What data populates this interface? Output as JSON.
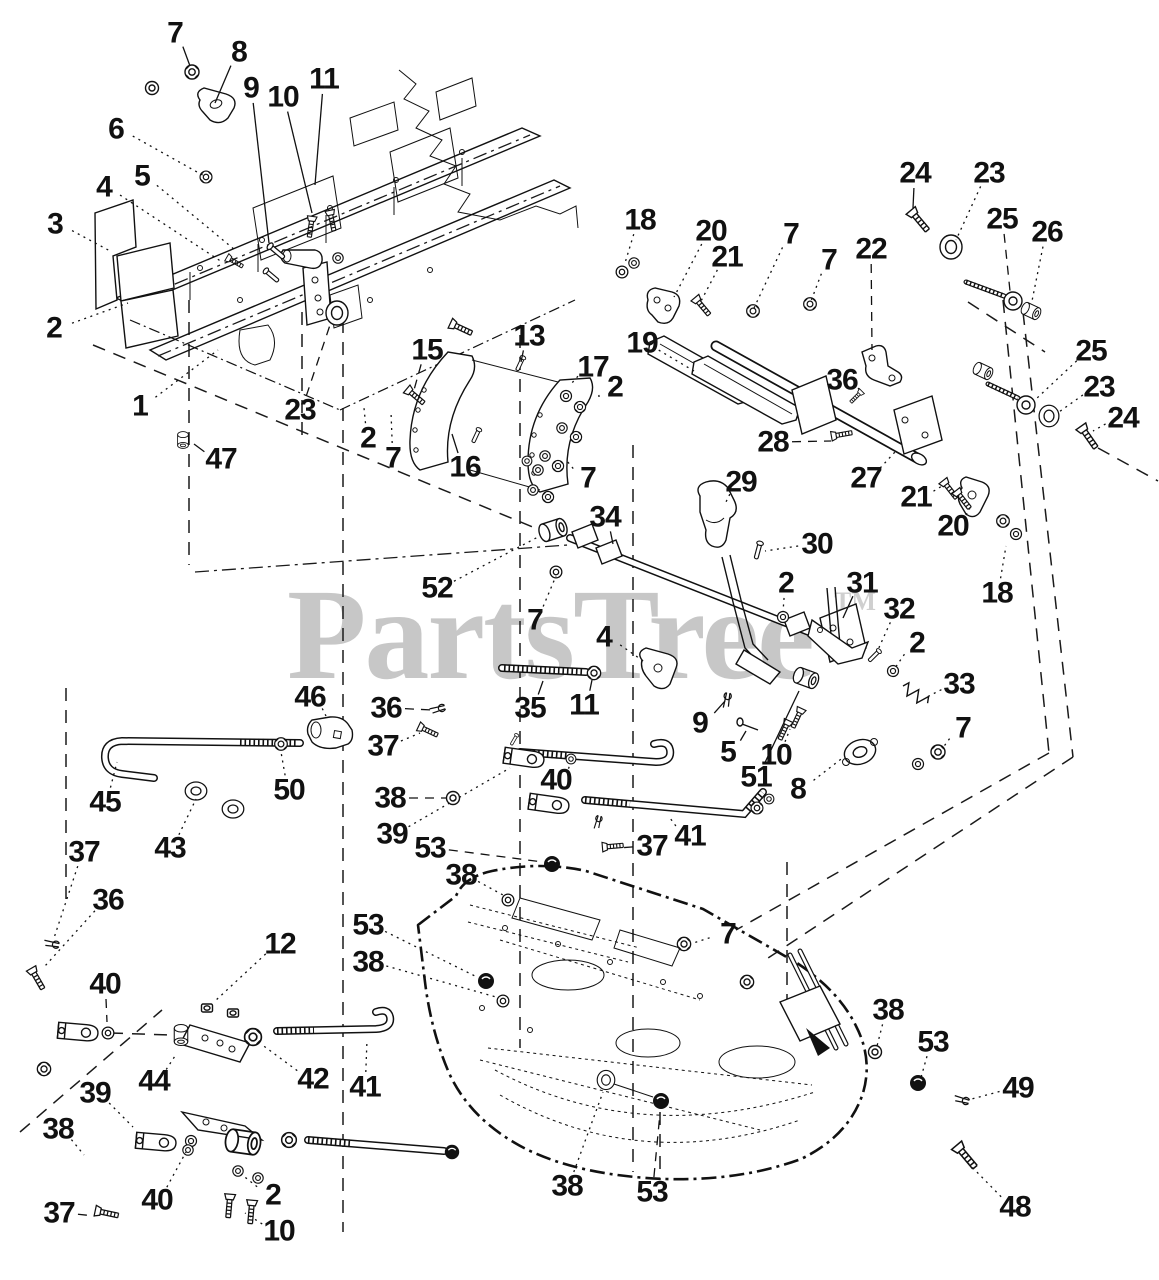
{
  "watermark": {
    "text": "PartsTree",
    "tm": "TM",
    "color": "#c7c7c7"
  },
  "diagram": {
    "ink": "#111111",
    "background": "#ffffff",
    "type": "exploded-parts-diagram",
    "subject": "mower deck lift linkage"
  },
  "callouts": [
    {
      "n": "7",
      "x": 175,
      "y": 33,
      "tx": 190,
      "ty": 66,
      "ls": "s"
    },
    {
      "n": "8",
      "x": 239,
      "y": 52,
      "tx": 215,
      "ty": 103,
      "ls": "s"
    },
    {
      "n": "9",
      "x": 251,
      "y": 88,
      "tx": 269,
      "ty": 243,
      "ls": "s"
    },
    {
      "n": "10",
      "x": 283,
      "y": 97,
      "tx": 312,
      "ty": 213,
      "ls": "s"
    },
    {
      "n": "11",
      "x": 324,
      "y": 79,
      "tx": 315,
      "ty": 185,
      "ls": "s"
    },
    {
      "n": "6",
      "x": 116,
      "y": 129,
      "tx": 206,
      "ty": 177,
      "ls": "o"
    },
    {
      "n": "5",
      "x": 142,
      "y": 176,
      "tx": 235,
      "ty": 250,
      "ls": "o"
    },
    {
      "n": "4",
      "x": 104,
      "y": 187,
      "tx": 222,
      "ty": 262,
      "ls": "o"
    },
    {
      "n": "3",
      "x": 55,
      "y": 224,
      "tx": 112,
      "ty": 252,
      "ls": "o"
    },
    {
      "n": "2",
      "x": 54,
      "y": 328,
      "tx": 128,
      "ty": 303,
      "ls": "o"
    },
    {
      "n": "1",
      "x": 140,
      "y": 406,
      "tx": 218,
      "ty": 350,
      "ls": "o"
    },
    {
      "n": "23",
      "x": 300,
      "y": 410,
      "tx": 331,
      "ty": 322,
      "ls": "a"
    },
    {
      "n": "47",
      "x": 221,
      "y": 459,
      "tx": 194,
      "ty": 444,
      "ls": "s"
    },
    {
      "n": "15",
      "x": 427,
      "y": 350,
      "tx": 414,
      "ty": 390,
      "ls": "a"
    },
    {
      "n": "13",
      "x": 529,
      "y": 336,
      "tx": 521,
      "ty": 362,
      "ls": "s"
    },
    {
      "n": "17",
      "x": 593,
      "y": 367,
      "tx": 571,
      "ty": 384,
      "ls": "o"
    },
    {
      "n": "2",
      "x": 615,
      "y": 387,
      "tx": 599,
      "ty": 397,
      "ls": "a"
    },
    {
      "n": "16",
      "x": 465,
      "y": 467,
      "tx": 452,
      "ty": 434,
      "ls": "s"
    },
    {
      "n": "7",
      "x": 588,
      "y": 478,
      "tx": 567,
      "ty": 461,
      "ls": "o"
    },
    {
      "n": "2",
      "x": 368,
      "y": 438,
      "tx": 364,
      "ty": 408,
      "ls": "o"
    },
    {
      "n": "7",
      "x": 393,
      "y": 458,
      "tx": 391,
      "ty": 412,
      "ls": "o"
    },
    {
      "n": "18",
      "x": 640,
      "y": 220,
      "tx": 625,
      "ty": 263,
      "ls": "o"
    },
    {
      "n": "20",
      "x": 711,
      "y": 231,
      "tx": 674,
      "ty": 297,
      "ls": "o"
    },
    {
      "n": "21",
      "x": 727,
      "y": 257,
      "tx": 700,
      "ty": 303,
      "ls": "o"
    },
    {
      "n": "7",
      "x": 791,
      "y": 234,
      "tx": 754,
      "ty": 308,
      "ls": "o"
    },
    {
      "n": "7",
      "x": 829,
      "y": 260,
      "tx": 811,
      "ty": 301,
      "ls": "o"
    },
    {
      "n": "22",
      "x": 871,
      "y": 249,
      "tx": 872,
      "ty": 350,
      "ls": "a"
    },
    {
      "n": "24",
      "x": 915,
      "y": 173,
      "tx": 913,
      "ty": 208,
      "ls": "s"
    },
    {
      "n": "23",
      "x": 989,
      "y": 173,
      "tx": 956,
      "ty": 240,
      "ls": "o"
    },
    {
      "n": "25",
      "x": 1002,
      "y": 219,
      "tx": 1010,
      "ty": 291,
      "ls": "a"
    },
    {
      "n": "26",
      "x": 1047,
      "y": 232,
      "tx": 1032,
      "ty": 301,
      "ls": "o"
    },
    {
      "n": "19",
      "x": 642,
      "y": 343,
      "tx": 694,
      "ty": 371,
      "ls": "o"
    },
    {
      "n": "36",
      "x": 842,
      "y": 380,
      "tx": 861,
      "ty": 392,
      "ls": "o"
    },
    {
      "n": "28",
      "x": 773,
      "y": 442,
      "tx": 831,
      "ty": 441,
      "ls": "a"
    },
    {
      "n": "27",
      "x": 866,
      "y": 478,
      "tx": 895,
      "ty": 452,
      "ls": "o"
    },
    {
      "n": "29",
      "x": 741,
      "y": 482,
      "tx": 725,
      "ty": 504,
      "ls": "o"
    },
    {
      "n": "21",
      "x": 916,
      "y": 497,
      "tx": 942,
      "ty": 486,
      "ls": "o"
    },
    {
      "n": "20",
      "x": 953,
      "y": 526,
      "tx": 970,
      "ty": 508,
      "ls": "o"
    },
    {
      "n": "18",
      "x": 997,
      "y": 593,
      "tx": 1006,
      "ty": 546,
      "ls": "o"
    },
    {
      "n": "25",
      "x": 1091,
      "y": 351,
      "tx": 1036,
      "ty": 399,
      "ls": "o"
    },
    {
      "n": "23",
      "x": 1099,
      "y": 387,
      "tx": 1059,
      "ty": 412,
      "ls": "o"
    },
    {
      "n": "24",
      "x": 1123,
      "y": 418,
      "tx": 1093,
      "ty": 431,
      "ls": "o"
    },
    {
      "n": "30",
      "x": 817,
      "y": 544,
      "tx": 765,
      "ty": 551,
      "ls": "o"
    },
    {
      "n": "34",
      "x": 605,
      "y": 517,
      "tx": 613,
      "ty": 544,
      "ls": "s"
    },
    {
      "n": "2",
      "x": 786,
      "y": 583,
      "tx": 783,
      "ty": 612,
      "ls": "o"
    },
    {
      "n": "31",
      "x": 862,
      "y": 583,
      "tx": 843,
      "ty": 618,
      "ls": "s"
    },
    {
      "n": "32",
      "x": 899,
      "y": 609,
      "tx": 877,
      "ty": 652,
      "ls": "o"
    },
    {
      "n": "2",
      "x": 917,
      "y": 643,
      "tx": 895,
      "ty": 668,
      "ls": "o"
    },
    {
      "n": "33",
      "x": 959,
      "y": 684,
      "tx": 927,
      "ty": 697,
      "ls": "o"
    },
    {
      "n": "7",
      "x": 963,
      "y": 728,
      "tx": 942,
      "ty": 749,
      "ls": "o"
    },
    {
      "n": "52",
      "x": 437,
      "y": 588,
      "tx": 538,
      "ty": 537,
      "ls": "o"
    },
    {
      "n": "7",
      "x": 535,
      "y": 620,
      "tx": 556,
      "ty": 576,
      "ls": "o"
    },
    {
      "n": "4",
      "x": 604,
      "y": 637,
      "tx": 646,
      "ty": 663,
      "ls": "o"
    },
    {
      "n": "35",
      "x": 530,
      "y": 708,
      "tx": 543,
      "ty": 681,
      "ls": "s"
    },
    {
      "n": "11",
      "x": 584,
      "y": 705,
      "tx": 592,
      "ty": 680,
      "ls": "s"
    },
    {
      "n": "9",
      "x": 700,
      "y": 723,
      "tx": 725,
      "ty": 701,
      "ls": "s"
    },
    {
      "n": "5",
      "x": 728,
      "y": 752,
      "tx": 746,
      "ty": 731,
      "ls": "s"
    },
    {
      "n": "10",
      "x": 776,
      "y": 755,
      "tx": 790,
      "ty": 729,
      "ls": "o"
    },
    {
      "n": "51",
      "x": 756,
      "y": 777,
      "tx": 799,
      "ty": 691,
      "ls": "s"
    },
    {
      "n": "8",
      "x": 798,
      "y": 789,
      "tx": 845,
      "ty": 756,
      "ls": "o"
    },
    {
      "n": "46",
      "x": 310,
      "y": 697,
      "tx": 326,
      "ty": 716,
      "ls": "o"
    },
    {
      "n": "36",
      "x": 386,
      "y": 708,
      "tx": 432,
      "ty": 710,
      "ls": "a"
    },
    {
      "n": "37",
      "x": 383,
      "y": 746,
      "tx": 420,
      "ty": 733,
      "ls": "o"
    },
    {
      "n": "38",
      "x": 390,
      "y": 798,
      "tx": 447,
      "ty": 798,
      "ls": "a"
    },
    {
      "n": "39",
      "x": 392,
      "y": 834,
      "tx": 510,
      "ty": 768,
      "ls": "o"
    },
    {
      "n": "50",
      "x": 289,
      "y": 790,
      "tx": 281,
      "ty": 752,
      "ls": "o"
    },
    {
      "n": "45",
      "x": 105,
      "y": 802,
      "tx": 117,
      "ty": 762,
      "ls": "o"
    },
    {
      "n": "43",
      "x": 170,
      "y": 848,
      "tx": 196,
      "ty": 799,
      "ls": "o"
    },
    {
      "n": "37",
      "x": 84,
      "y": 852,
      "tx": 54,
      "ty": 938,
      "ls": "o"
    },
    {
      "n": "36",
      "x": 108,
      "y": 900,
      "tx": 45,
      "ty": 966,
      "ls": "o"
    },
    {
      "n": "12",
      "x": 280,
      "y": 944,
      "tx": 214,
      "ty": 1002,
      "ls": "o"
    },
    {
      "n": "40",
      "x": 556,
      "y": 780,
      "tx": 570,
      "ty": 764,
      "ls": "o"
    },
    {
      "n": "41",
      "x": 690,
      "y": 836,
      "tx": 670,
      "ty": 818,
      "ls": "o"
    },
    {
      "n": "37",
      "x": 652,
      "y": 846,
      "tx": 618,
      "ty": 848,
      "ls": "a"
    },
    {
      "n": "53",
      "x": 430,
      "y": 848,
      "tx": 543,
      "ty": 862,
      "ls": "a"
    },
    {
      "n": "38",
      "x": 461,
      "y": 875,
      "tx": 503,
      "ty": 895,
      "ls": "o"
    },
    {
      "n": "53",
      "x": 368,
      "y": 925,
      "tx": 477,
      "ty": 977,
      "ls": "o"
    },
    {
      "n": "38",
      "x": 368,
      "y": 962,
      "tx": 496,
      "ty": 997,
      "ls": "o"
    },
    {
      "n": "40",
      "x": 105,
      "y": 984,
      "tx": 107,
      "ty": 1022,
      "ls": "a"
    },
    {
      "n": "44",
      "x": 154,
      "y": 1081,
      "tx": 175,
      "ty": 1056,
      "ls": "o"
    },
    {
      "n": "42",
      "x": 313,
      "y": 1079,
      "tx": 261,
      "ty": 1044,
      "ls": "o"
    },
    {
      "n": "41",
      "x": 365,
      "y": 1087,
      "tx": 367,
      "ty": 1040,
      "ls": "o"
    },
    {
      "n": "39",
      "x": 95,
      "y": 1093,
      "tx": 133,
      "ty": 1127,
      "ls": "o"
    },
    {
      "n": "38",
      "x": 58,
      "y": 1129,
      "tx": 84,
      "ty": 1155,
      "ls": "o"
    },
    {
      "n": "40",
      "x": 157,
      "y": 1200,
      "tx": 186,
      "ty": 1152,
      "ls": "o"
    },
    {
      "n": "2",
      "x": 273,
      "y": 1195,
      "tx": 241,
      "ty": 1174,
      "ls": "o"
    },
    {
      "n": "37",
      "x": 59,
      "y": 1213,
      "tx": 95,
      "ty": 1216,
      "ls": "a"
    },
    {
      "n": "10",
      "x": 279,
      "y": 1231,
      "tx": 245,
      "ty": 1213,
      "ls": "o"
    },
    {
      "n": "38",
      "x": 567,
      "y": 1186,
      "tx": 603,
      "ty": 1092,
      "ls": "o"
    },
    {
      "n": "53",
      "x": 652,
      "y": 1192,
      "tx": 660,
      "ty": 1113,
      "ls": "a"
    },
    {
      "n": "7",
      "x": 728,
      "y": 934,
      "tx": 690,
      "ty": 944,
      "ls": "o"
    },
    {
      "n": "38",
      "x": 888,
      "y": 1010,
      "tx": 876,
      "ty": 1050,
      "ls": "o"
    },
    {
      "n": "53",
      "x": 933,
      "y": 1042,
      "tx": 920,
      "ty": 1081,
      "ls": "o"
    },
    {
      "n": "49",
      "x": 1018,
      "y": 1088,
      "tx": 968,
      "ty": 1100,
      "ls": "o"
    },
    {
      "n": "48",
      "x": 1015,
      "y": 1207,
      "tx": 968,
      "ty": 1163,
      "ls": "o"
    }
  ],
  "hardware": [
    {
      "g": "washer",
      "x": 152,
      "y": 88
    },
    {
      "g": "nut",
      "x": 192,
      "y": 72
    },
    {
      "g": "nut",
      "x": 206,
      "y": 177,
      "s": 0.85
    },
    {
      "g": "boltv",
      "x": 312,
      "y": 218,
      "r": 8,
      "s": 0.8
    },
    {
      "g": "boltv",
      "x": 330,
      "y": 212,
      "r": -12,
      "s": 0.8
    },
    {
      "g": "pin",
      "x": 277,
      "y": 252,
      "r": -50,
      "s": 0.9
    },
    {
      "g": "pin",
      "x": 272,
      "y": 276,
      "r": -50,
      "s": 0.8
    },
    {
      "g": "washer",
      "x": 338,
      "y": 258,
      "s": 0.8
    },
    {
      "g": "disc",
      "x": 337,
      "y": 313
    },
    {
      "g": "boltv",
      "x": 228,
      "y": 258,
      "r": -60,
      "s": 0.7
    },
    {
      "g": "bushing",
      "x": 183,
      "y": 440,
      "r": 90,
      "s": 0.6
    },
    {
      "g": "washer",
      "x": 622,
      "y": 272,
      "s": 0.9
    },
    {
      "g": "washer",
      "x": 634,
      "y": 263,
      "s": 0.8
    },
    {
      "g": "boltv",
      "x": 696,
      "y": 299,
      "r": -40,
      "s": 0.85
    },
    {
      "g": "nut",
      "x": 753,
      "y": 311,
      "s": 0.9
    },
    {
      "g": "nut",
      "x": 810,
      "y": 304,
      "s": 0.9
    },
    {
      "g": "boltv",
      "x": 861,
      "y": 392,
      "r": 45,
      "s": 0.6
    },
    {
      "g": "boltv",
      "x": 833,
      "y": 436,
      "r": -100,
      "s": 0.8
    },
    {
      "g": "boltv",
      "x": 912,
      "y": 212,
      "r": -40
    },
    {
      "g": "disc",
      "x": 951,
      "y": 247
    },
    {
      "g": "eye",
      "x": 1013,
      "y": 301
    },
    {
      "g": "bushing",
      "x": 1031,
      "y": 311,
      "r": 25,
      "s": 0.7
    },
    {
      "g": "bushing",
      "x": 983,
      "y": 371,
      "r": 25,
      "s": 0.7
    },
    {
      "g": "eye",
      "x": 1026,
      "y": 405
    },
    {
      "g": "disc",
      "x": 1049,
      "y": 416,
      "s": 0.9
    },
    {
      "g": "boltv",
      "x": 1082,
      "y": 428,
      "r": -35
    },
    {
      "g": "boltv",
      "x": 944,
      "y": 482,
      "r": -38,
      "s": 0.85
    },
    {
      "g": "boltv",
      "x": 957,
      "y": 492,
      "r": -38,
      "s": 0.85
    },
    {
      "g": "nut",
      "x": 1003,
      "y": 521,
      "s": 0.9
    },
    {
      "g": "washer",
      "x": 1016,
      "y": 534,
      "s": 0.85
    },
    {
      "g": "pin",
      "x": 758,
      "y": 551,
      "r": 15,
      "s": 0.8
    },
    {
      "g": "washer",
      "x": 556,
      "y": 572,
      "s": 0.9
    },
    {
      "g": "washer",
      "x": 783,
      "y": 617,
      "s": 0.85
    },
    {
      "g": "pin",
      "x": 874,
      "y": 656,
      "r": 45,
      "s": 0.7
    },
    {
      "g": "washer",
      "x": 893,
      "y": 671,
      "s": 0.85
    },
    {
      "g": "spring",
      "x": 903,
      "y": 686,
      "r": 35
    },
    {
      "g": "nut",
      "x": 938,
      "y": 752
    },
    {
      "g": "washer",
      "x": 918,
      "y": 764,
      "s": 0.85
    },
    {
      "g": "cotter",
      "x": 727,
      "y": 700,
      "r": 10,
      "s": 0.9
    },
    {
      "g": "nut",
      "x": 594,
      "y": 673,
      "s": 0.95
    },
    {
      "g": "bushing",
      "x": 553,
      "y": 530,
      "r": -18
    },
    {
      "g": "bushing",
      "x": 806,
      "y": 678,
      "r": 20,
      "s": 0.9
    },
    {
      "g": "boltv",
      "x": 788,
      "y": 722,
      "r": 25,
      "s": 0.8
    },
    {
      "g": "boltv",
      "x": 801,
      "y": 710,
      "r": 25,
      "s": 0.8
    },
    {
      "g": "nut",
      "x": 281,
      "y": 744,
      "s": 0.9
    },
    {
      "g": "ring",
      "x": 196,
      "y": 791,
      "s": 0.9
    },
    {
      "g": "ring",
      "x": 233,
      "y": 809,
      "s": 0.9
    },
    {
      "g": "cotter",
      "x": 438,
      "y": 709,
      "r": 75,
      "s": 0.9
    },
    {
      "g": "boltv",
      "x": 420,
      "y": 727,
      "r": -65,
      "s": 0.8
    },
    {
      "g": "washer",
      "x": 453,
      "y": 798
    },
    {
      "g": "clevis",
      "x": 524,
      "y": 758,
      "r": 8
    },
    {
      "g": "pin",
      "x": 514,
      "y": 740,
      "r": 30,
      "s": 0.55
    },
    {
      "g": "washer",
      "x": 571,
      "y": 759,
      "s": 0.75
    },
    {
      "g": "clevis",
      "x": 549,
      "y": 804,
      "r": 8
    },
    {
      "g": "cotter",
      "x": 598,
      "y": 822,
      "r": 15,
      "s": 0.8
    },
    {
      "g": "boltv",
      "x": 604,
      "y": 847,
      "r": -95,
      "s": 0.8
    },
    {
      "g": "nut",
      "x": 757,
      "y": 808,
      "s": 0.85
    },
    {
      "g": "washer",
      "x": 769,
      "y": 799,
      "s": 0.75
    },
    {
      "g": "nutdark",
      "x": 552,
      "y": 864
    },
    {
      "g": "washer",
      "x": 508,
      "y": 900,
      "s": 0.9
    },
    {
      "g": "nut",
      "x": 684,
      "y": 944,
      "s": 0.95
    },
    {
      "g": "nut",
      "x": 747,
      "y": 982,
      "s": 0.95
    },
    {
      "g": "nutdark",
      "x": 486,
      "y": 981
    },
    {
      "g": "washer",
      "x": 503,
      "y": 1001,
      "s": 0.9
    },
    {
      "g": "cotter",
      "x": 52,
      "y": 944,
      "r": 100,
      "s": 0.9
    },
    {
      "g": "boltv",
      "x": 32,
      "y": 970,
      "r": -30,
      "s": 0.9
    },
    {
      "g": "clevis",
      "x": 78,
      "y": 1032,
      "r": 5
    },
    {
      "g": "washer",
      "x": 108,
      "y": 1033,
      "s": 0.9
    },
    {
      "g": "nut",
      "x": 44,
      "y": 1069,
      "s": 0.95
    },
    {
      "g": "sqnut",
      "x": 207,
      "y": 1008
    },
    {
      "g": "sqnut",
      "x": 233,
      "y": 1013
    },
    {
      "g": "bushing",
      "x": 181,
      "y": 1035,
      "r": 90,
      "s": 0.75
    },
    {
      "g": "nut",
      "x": 253,
      "y": 1037,
      "s": 1.2
    },
    {
      "g": "clevis",
      "x": 156,
      "y": 1142,
      "r": 5
    },
    {
      "g": "washer",
      "x": 191,
      "y": 1141,
      "s": 0.85
    },
    {
      "g": "bushing",
      "x": 243,
      "y": 1142,
      "r": 8,
      "s": 1.25
    },
    {
      "g": "nut",
      "x": 289,
      "y": 1140,
      "s": 1.05
    },
    {
      "g": "nutdark",
      "x": 452,
      "y": 1152,
      "s": 0.9
    },
    {
      "g": "washer",
      "x": 238,
      "y": 1171,
      "s": 0.8
    },
    {
      "g": "washer",
      "x": 258,
      "y": 1178,
      "s": 0.8
    },
    {
      "g": "washer",
      "x": 188,
      "y": 1150,
      "s": 0.8
    },
    {
      "g": "boltv",
      "x": 230,
      "y": 1196,
      "r": 5,
      "s": 0.9
    },
    {
      "g": "boltv",
      "x": 252,
      "y": 1202,
      "r": 5,
      "s": 0.9
    },
    {
      "g": "boltv",
      "x": 97,
      "y": 1211,
      "r": -78,
      "s": 0.9
    },
    {
      "g": "washer",
      "x": 875,
      "y": 1052
    },
    {
      "g": "nutdark",
      "x": 918,
      "y": 1083
    },
    {
      "g": "cotter",
      "x": 962,
      "y": 1100,
      "r": 105,
      "s": 0.9
    },
    {
      "g": "boltv",
      "x": 958,
      "y": 1147,
      "r": -40,
      "s": 1.1
    },
    {
      "g": "nutdark",
      "x": 661,
      "y": 1101
    },
    {
      "g": "disc",
      "x": 606,
      "y": 1080,
      "s": 0.8
    },
    {
      "g": "washer",
      "x": 566,
      "y": 396,
      "s": 0.85
    },
    {
      "g": "nut",
      "x": 580,
      "y": 407,
      "s": 0.8
    },
    {
      "g": "washer",
      "x": 562,
      "y": 428,
      "s": 0.8
    },
    {
      "g": "nut",
      "x": 576,
      "y": 437,
      "s": 0.8
    },
    {
      "g": "washer",
      "x": 545,
      "y": 456,
      "s": 0.8
    },
    {
      "g": "nut",
      "x": 558,
      "y": 466,
      "s": 0.8
    },
    {
      "g": "washer",
      "x": 538,
      "y": 470,
      "s": 0.8
    },
    {
      "g": "washer",
      "x": 527,
      "y": 461,
      "s": 0.75
    },
    {
      "g": "washer",
      "x": 533,
      "y": 490,
      "s": 0.8
    },
    {
      "g": "nut",
      "x": 548,
      "y": 497,
      "s": 0.8
    },
    {
      "g": "boltv",
      "x": 452,
      "y": 324,
      "r": -65,
      "s": 0.9
    },
    {
      "g": "boltv",
      "x": 408,
      "y": 390,
      "r": -50,
      "s": 0.85
    },
    {
      "g": "pin",
      "x": 520,
      "y": 364,
      "r": 25,
      "s": 0.7
    },
    {
      "g": "pin",
      "x": 476,
      "y": 436,
      "r": 25,
      "s": 0.7
    }
  ]
}
